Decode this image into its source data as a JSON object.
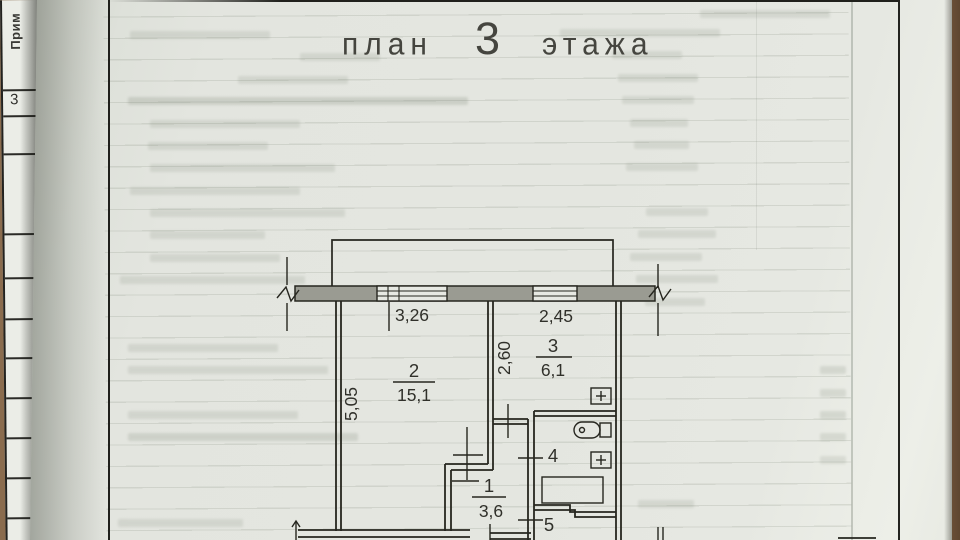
{
  "document": {
    "title": {
      "prefix": "план",
      "floor_number": "3",
      "suffix": "этажа"
    }
  },
  "side_table": {
    "column_header": "Прим",
    "row_number": "3"
  },
  "floor_plan": {
    "dimensions": {
      "window_left_width": "3,26",
      "window_right_width": "2,45",
      "room3_depth": "2,60",
      "room2_depth": "5,05"
    },
    "rooms": [
      {
        "number": "2",
        "area": "15,1"
      },
      {
        "number": "3",
        "area": "6,1"
      },
      {
        "number": "1",
        "area": "3,6"
      },
      {
        "number": "4"
      },
      {
        "number": "5"
      }
    ],
    "fixtures": [
      "sink",
      "toilet",
      "sink",
      "bathtub"
    ]
  },
  "colors": {
    "paper": "#e4e6e0",
    "wall_fill": "#9a9b92",
    "ink": "#26261f",
    "desk": "#8a6c4e"
  }
}
